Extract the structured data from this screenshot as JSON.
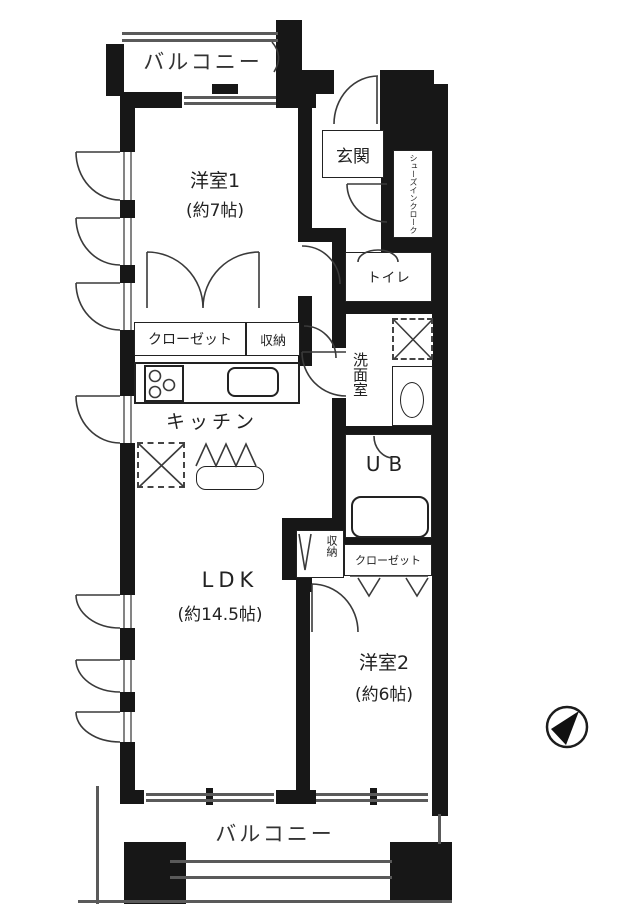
{
  "plan": {
    "balcony_top_label": "バルコニー",
    "balcony_bottom_label": "バルコニー",
    "room1": {
      "name": "洋室1",
      "size": "(約7帖)"
    },
    "entrance_label": "玄関",
    "shoes_in_closet_label": "シューズインクローク",
    "toilet_label": "トイレ",
    "closet_main_label": "クローゼット",
    "storage_hall_label": "収納",
    "washroom_label": "洗面室",
    "kitchen_label": "キッチン",
    "unit_bath_label": "UB",
    "storage_mid_label": "収納",
    "closet_room2_label": "クローゼット",
    "ldk": {
      "name": "LDK",
      "size": "(約14.5帖)"
    },
    "room2": {
      "name": "洋室2",
      "size": "(約6帖)"
    }
  },
  "icons": {
    "compass": "north-compass-icon",
    "stove": "stove-icon",
    "sink": "kitchen-sink-icon",
    "bathtub": "bathtub-icon",
    "washbasin": "washbasin-icon",
    "washer_space": "washing-machine-space-icon",
    "fridge_space": "refrigerator-space-icon"
  },
  "colors": {
    "wall": "#171717",
    "line": "#3a3a3a",
    "text": "#222222",
    "background": "#ffffff"
  }
}
